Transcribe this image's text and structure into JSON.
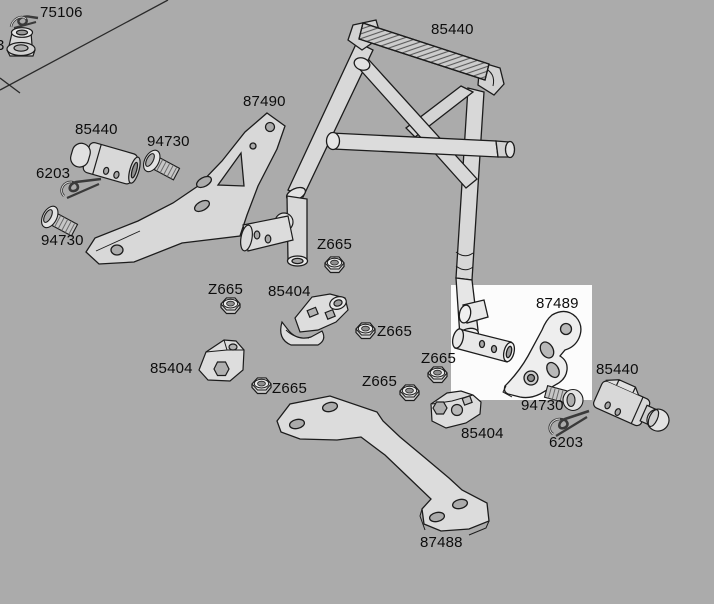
{
  "diagram": {
    "type": "exploded-parts-diagram",
    "colors": {
      "background": "#ababab",
      "highlight": "#fcfcfc",
      "line": "#1c1c1c",
      "part_fill": "#d8d8d8"
    },
    "highlight_box": {
      "x": 451,
      "y": 285,
      "width": 141,
      "height": 115
    },
    "part_numbers": [
      "75106",
      "85440",
      "87490",
      "94730",
      "6203",
      "Z665",
      "85404",
      "87489",
      "87488"
    ],
    "labels": [
      {
        "text": "75106",
        "x": 40,
        "y": 4
      },
      {
        "text": "3",
        "x": -4,
        "y": 37
      },
      {
        "text": "85440",
        "x": 431,
        "y": 21
      },
      {
        "text": "87490",
        "x": 243,
        "y": 93
      },
      {
        "text": "85440",
        "x": 75,
        "y": 121
      },
      {
        "text": "94730",
        "x": 147,
        "y": 133
      },
      {
        "text": "6203",
        "x": 36,
        "y": 165
      },
      {
        "text": "94730",
        "x": 41,
        "y": 232
      },
      {
        "text": "Z665",
        "x": 317,
        "y": 236
      },
      {
        "text": "Z665",
        "x": 208,
        "y": 281
      },
      {
        "text": "85404",
        "x": 268,
        "y": 283
      },
      {
        "text": "Z665",
        "x": 377,
        "y": 323
      },
      {
        "text": "85404",
        "x": 150,
        "y": 360
      },
      {
        "text": "Z665",
        "x": 421,
        "y": 350
      },
      {
        "text": "Z665",
        "x": 362,
        "y": 373
      },
      {
        "text": "Z665",
        "x": 272,
        "y": 380
      },
      {
        "text": "87489",
        "x": 536,
        "y": 295
      },
      {
        "text": "85440",
        "x": 596,
        "y": 361
      },
      {
        "text": "94730",
        "x": 521,
        "y": 397
      },
      {
        "text": "85404",
        "x": 461,
        "y": 425
      },
      {
        "text": "6203",
        "x": 549,
        "y": 434
      },
      {
        "text": "87488",
        "x": 420,
        "y": 534
      }
    ]
  }
}
